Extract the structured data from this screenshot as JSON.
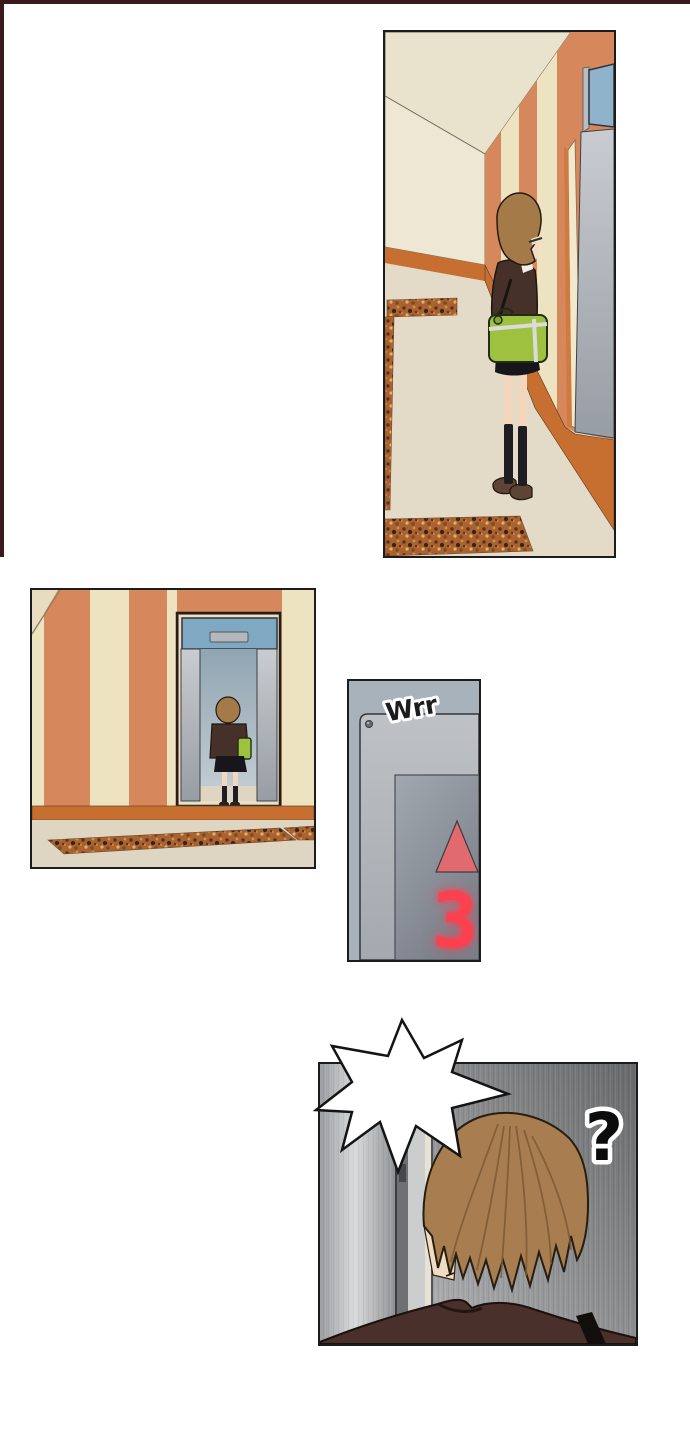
{
  "page": {
    "background": "#ffffff",
    "frame_color": "#3a1a1c"
  },
  "palette": {
    "wall_orange": "#d6875b",
    "wall_cream": "#eee3c1",
    "baseboard_orange": "#c76e31",
    "floor_cream": "#e3dac7",
    "granite_base": "#a96230",
    "elevator_door_gray": "#b3b7bc",
    "transom_blue": "#8fb3ca",
    "hair_brown": "#a57a49",
    "jacket_brown": "#46302a",
    "bag_green": "#9fc140",
    "indicator_red": "#fb4050",
    "metal_wall_gray": "#8e8f91"
  },
  "panels": [
    {
      "id": "panel-1",
      "alt": "Girl with a green shoulder bag stands in a striped hallway facing an elevator"
    },
    {
      "id": "panel-2",
      "alt": "The girl steps into the open elevator, seen from behind"
    },
    {
      "id": "panel-3",
      "alt": "Close-up of the elevator indicator panel",
      "sfx": "Wrr",
      "arrow": "up",
      "floor_display": "3"
    },
    {
      "id": "panel-4",
      "alt": "Back of the girl's head in front of the elevator doors",
      "sfx": "?"
    }
  ]
}
